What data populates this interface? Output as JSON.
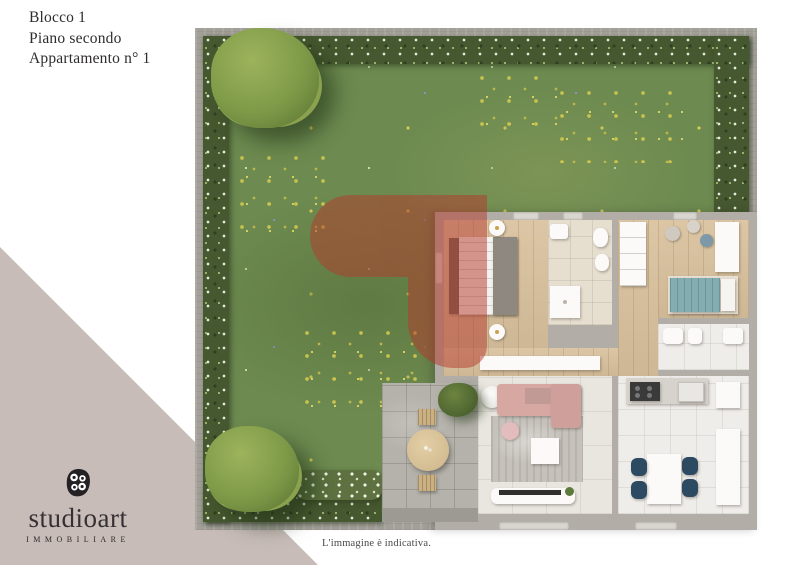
{
  "header": {
    "block": "Blocco 1",
    "floor": "Piano secondo",
    "apartment": "Appartamento n° 1"
  },
  "brand": {
    "name": "studioart",
    "tagline": "IMMOBILIARE",
    "logo_icon": "studioart-dots-mark"
  },
  "footer": {
    "disclaimer": "L'immagine è indicativa."
  },
  "floorplan": {
    "type": "top-down 3D render",
    "areas": [
      "garden",
      "hedge border",
      "patio with round table",
      "bedroom",
      "bathroom",
      "hallway",
      "second bedroom",
      "second bathroom",
      "kitchen-dining",
      "living room"
    ],
    "watermark": "studioart red mark overlay"
  },
  "colors": {
    "corner_mauve": "#c8bcb9",
    "grass": "#6d8a50",
    "hedge": "#46582f",
    "concrete_frame": "#a3a099",
    "wall": "#b2aea7",
    "wood_floor": "#d9c19d",
    "watermark_red": "#b5392c",
    "bed2_teal": "#83adb0",
    "chairs_navy": "#2d4a63",
    "sofa_pink": "#d7a8a2"
  }
}
